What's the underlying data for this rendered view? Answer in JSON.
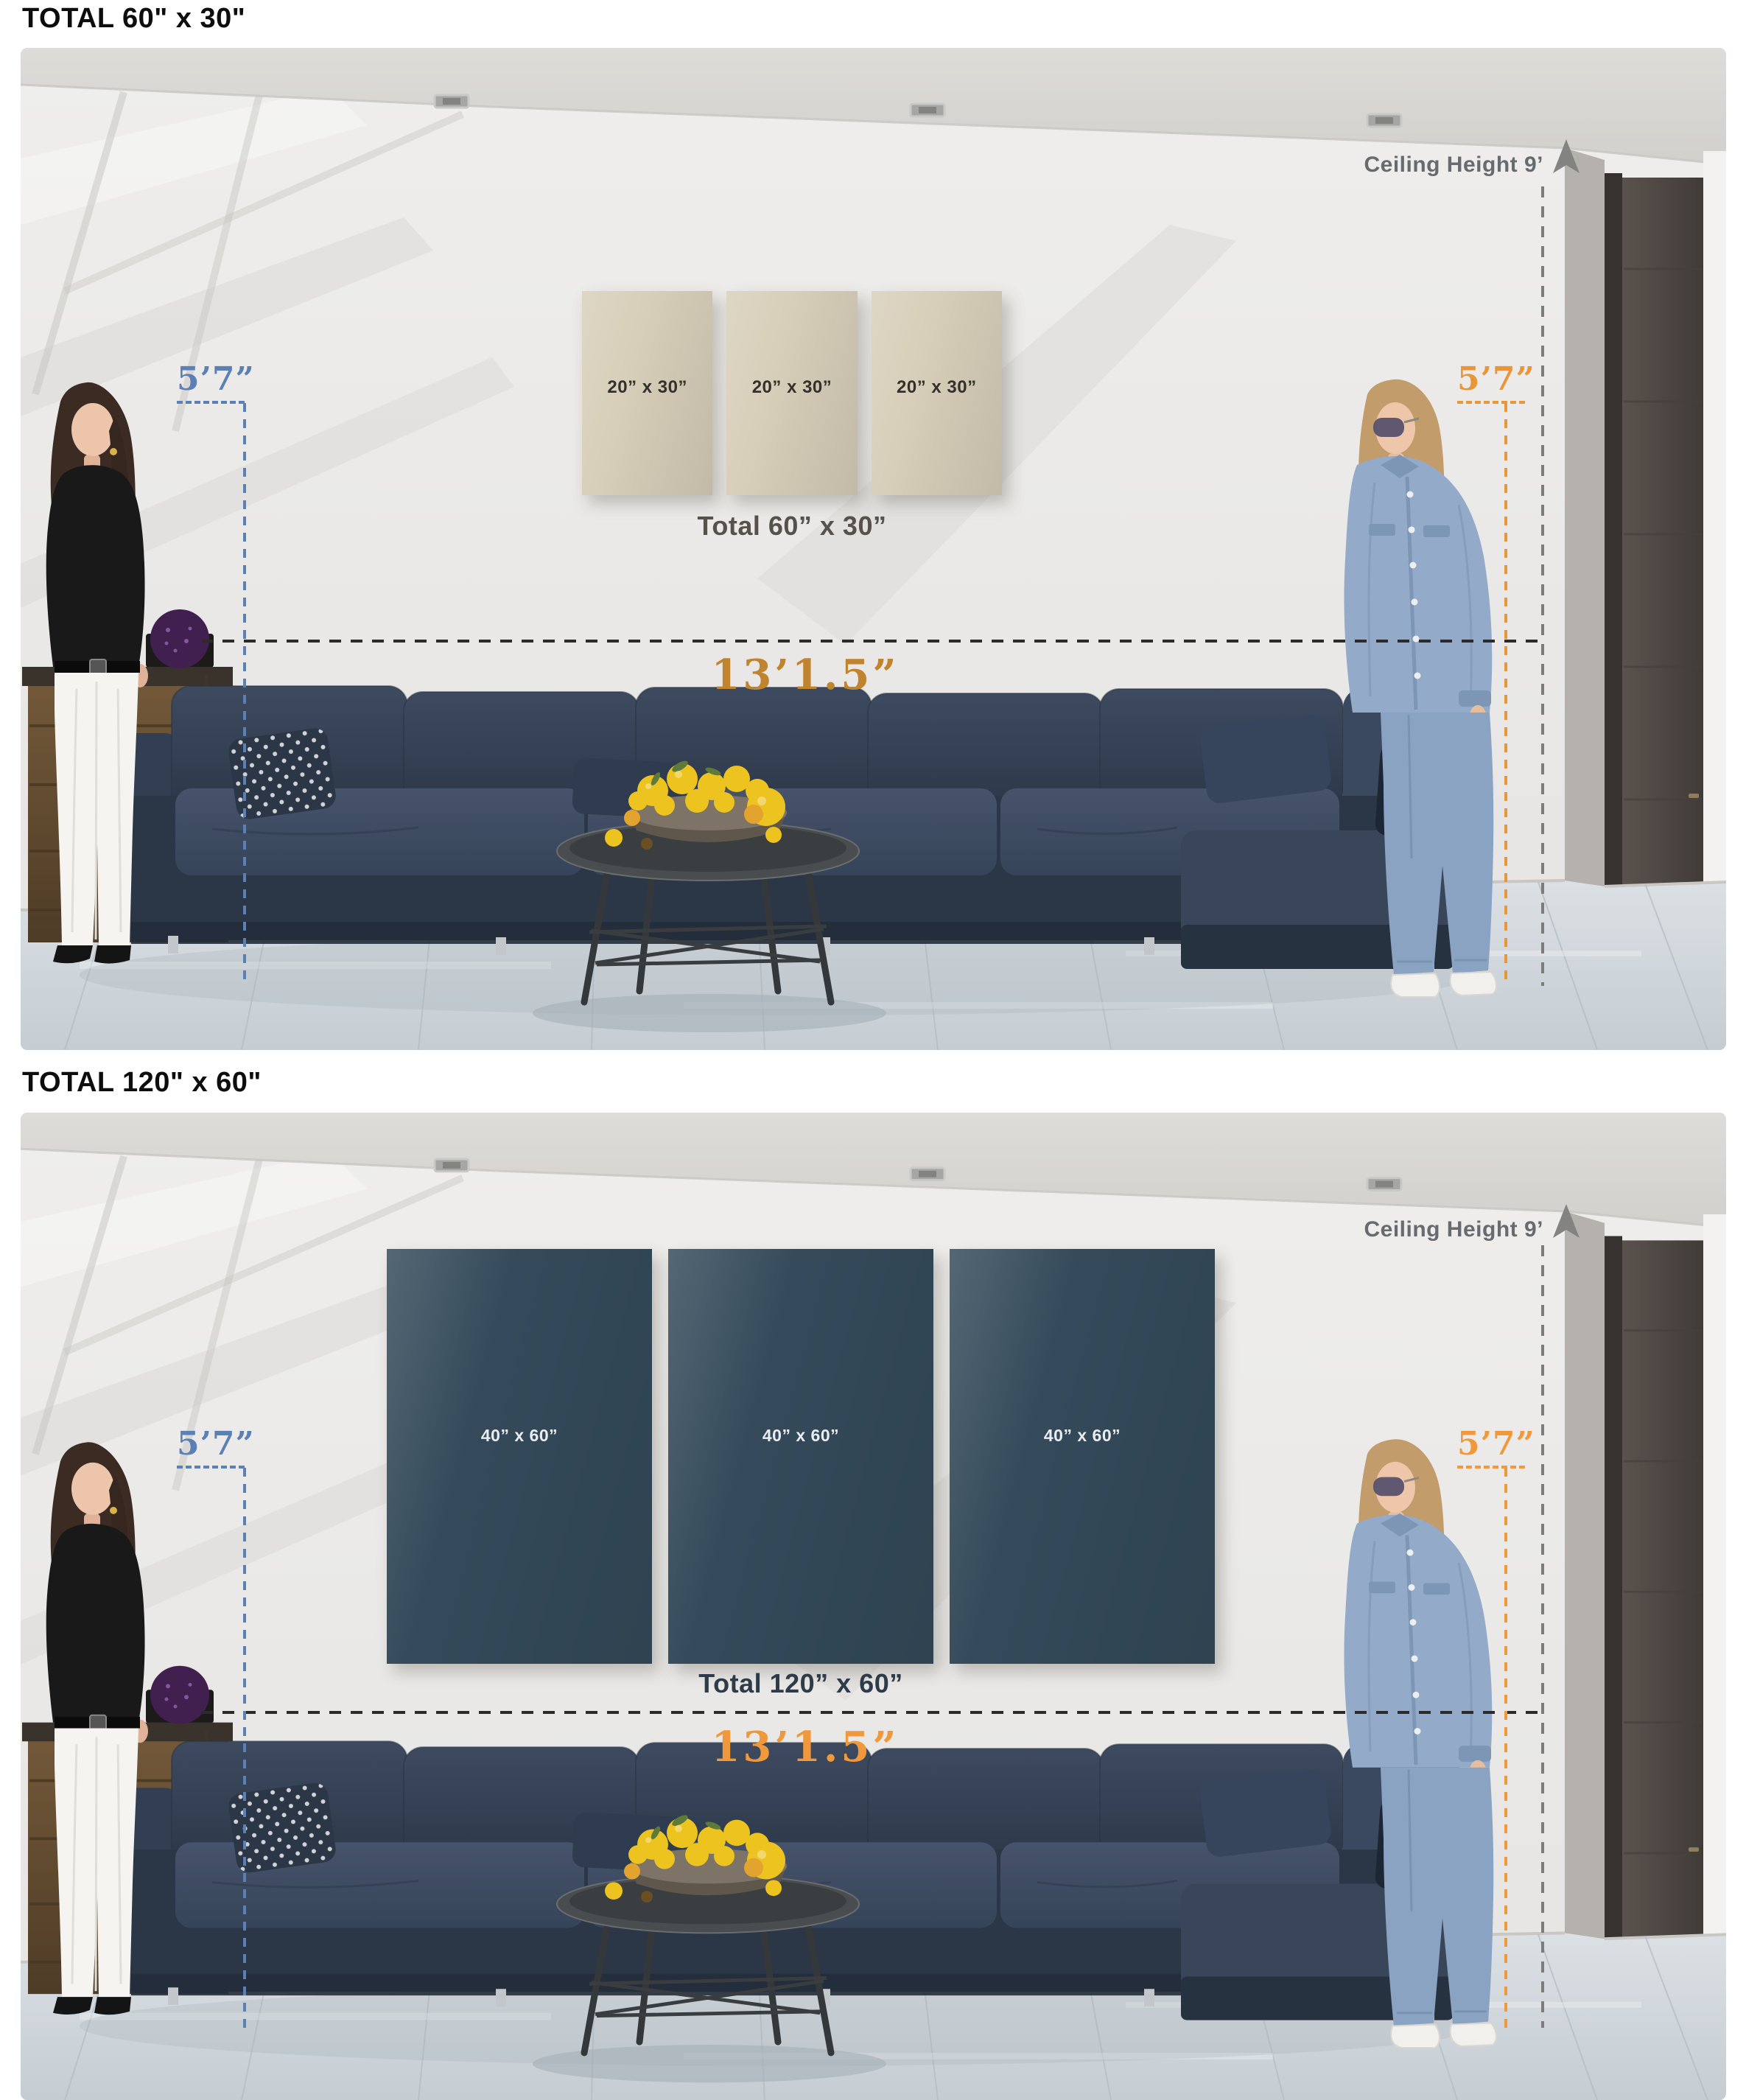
{
  "panels": [
    {
      "title": "TOTAL 60\" x 30\"",
      "canvases": [
        {
          "label": "20” x 30”"
        },
        {
          "label": "20” x 30”"
        },
        {
          "label": "20” x 30”"
        }
      ],
      "total_label": "Total 60” x 30”",
      "sofa_width_label": "13’1.5”",
      "ceiling_label": "Ceiling Height 9’",
      "left_person_height": "5’7”",
      "right_person_height": "5’7”",
      "canvas_color": "#d8cfba",
      "canvas_text_color": "#35302a",
      "dim_label_color": "#c0842f",
      "right_height_color": "#e8963a",
      "left_height_color": "#5b80b4"
    },
    {
      "title": "TOTAL 120\" x 60\"",
      "canvases": [
        {
          "label": "40” x 60”"
        },
        {
          "label": "40” x 60”"
        },
        {
          "label": "40” x 60”"
        }
      ],
      "total_label": "Total 120” x 60”",
      "sofa_width_label": "13’1.5”",
      "ceiling_label": "Ceiling Height 9’",
      "left_person_height": "5’7”",
      "right_person_height": "5’7”",
      "canvas_color": "#344a5a",
      "canvas_text_color": "#e9edf0",
      "dim_label_color": "#f0993c",
      "right_height_color": "#f0993c",
      "left_height_color": "#5b80b4"
    }
  ]
}
